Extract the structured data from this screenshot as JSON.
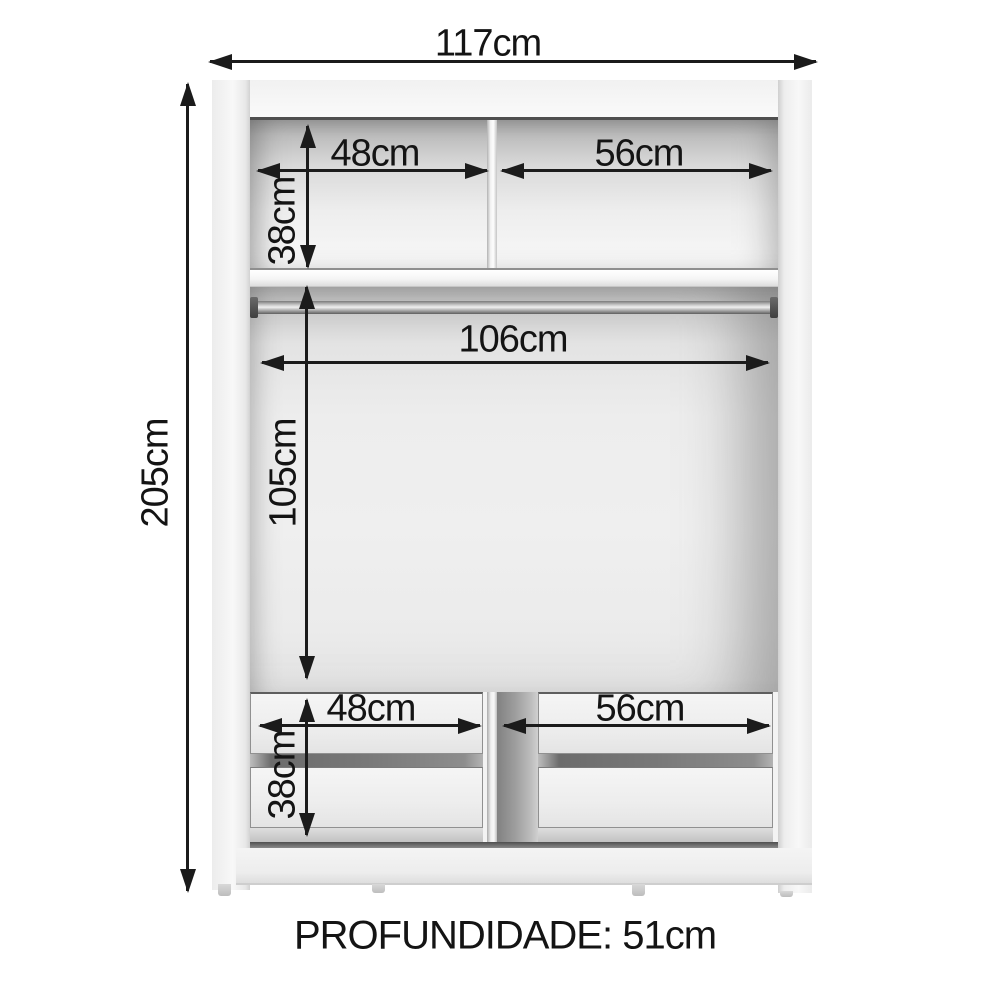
{
  "diagram": {
    "type": "wardrobe-internal-dimensions",
    "dims": {
      "overall_width": "117cm",
      "overall_height": "205cm",
      "upper_left_width": "48cm",
      "upper_right_width": "56cm",
      "upper_shelf_height": "38cm",
      "hanging_width": "106cm",
      "hanging_height": "105cm",
      "lower_left_width": "48cm",
      "lower_right_width": "56cm",
      "lower_drawer_height": "38cm"
    },
    "footer": {
      "depth_label": "PROFUNDIDADE: 51cm"
    },
    "colors": {
      "background": "#ffffff",
      "dimension_line": "#1b1b1b",
      "carcass_light": "#f3f3f3",
      "interior_shadow": "#a8a8a8",
      "rod_metal": "#8f8f8f"
    }
  }
}
